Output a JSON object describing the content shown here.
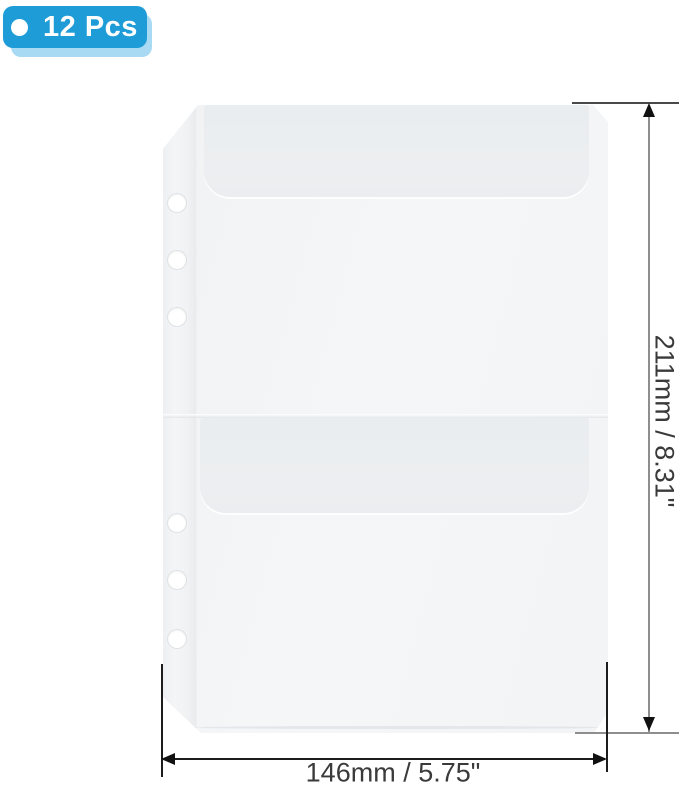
{
  "badge": {
    "label": "12 Pcs",
    "color": "#1E9CD8",
    "shadow_color": "#A9DAF3"
  },
  "product": {
    "ring_holes": 6,
    "pockets": 2,
    "body_color": "#F3F5F7",
    "flap_color": "#ECEEF1"
  },
  "dimensions": {
    "height_label": "211mm / 8.31\"",
    "width_label": "146mm / 5.75\"",
    "height_line_color": "#8E8E8E",
    "width_line_color": "#1C1C1C",
    "arrow_color": "#111111"
  }
}
